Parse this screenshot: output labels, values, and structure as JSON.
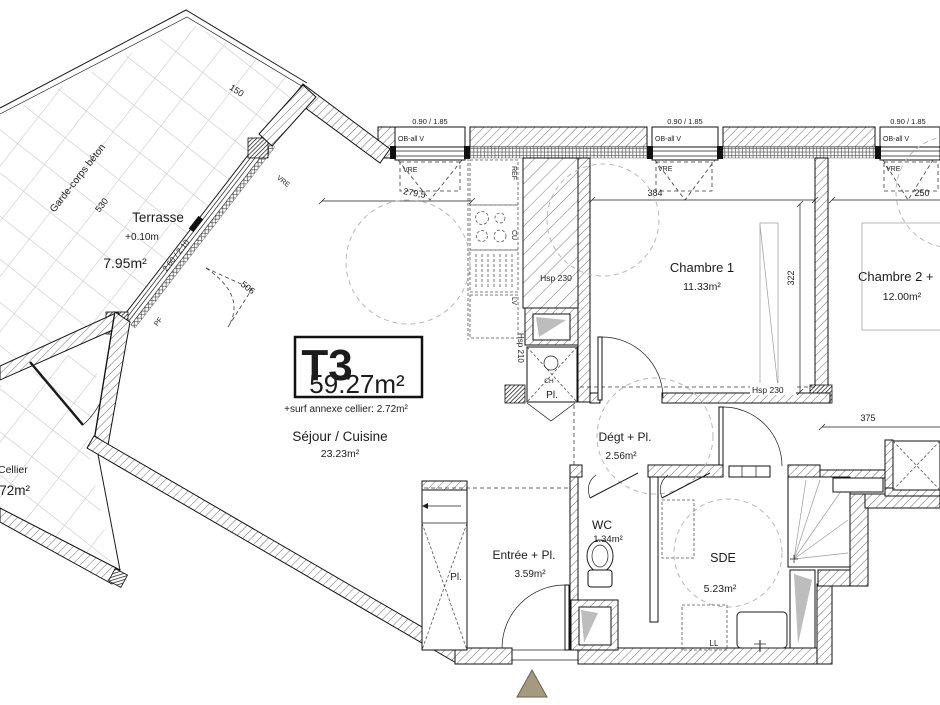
{
  "unit": {
    "type": "T3",
    "area": "59.27m²",
    "annex": "+surf annexe cellier: 2.72m²"
  },
  "rooms": {
    "terrasse": {
      "name": "Terrasse",
      "level": "+0.10m",
      "area": "7.95m²"
    },
    "sejour": {
      "name": "Séjour / Cuisine",
      "area": "23.23m²"
    },
    "chambre1": {
      "name": "Chambre 1",
      "area": "11.33m²"
    },
    "chambre2": {
      "name": "Chambre 2 +",
      "area": "12.00m²"
    },
    "degagement": {
      "name": "Dégt + Pl.",
      "area": "2.56m²"
    },
    "wc": {
      "name": "WC",
      "area": "1.34m²"
    },
    "sde": {
      "name": "SDE",
      "area": "5.23m²"
    },
    "entree": {
      "name": "Entrée + Pl.",
      "area": "3.59m²"
    },
    "cellier": {
      "name": "Cellier",
      "area": "2.72m²"
    }
  },
  "labels": {
    "garde_corps": "Garde-corps béton",
    "pl": "Pl.",
    "ch": "CH",
    "ref": "REF",
    "cu": "CU",
    "lv": "LV",
    "ll": "LL",
    "pf": "PF",
    "vre": "VRE",
    "ob": "OB-all V",
    "hsp230": "Hsp 230",
    "hsp210": "Hsp 210",
    "win_small": "0.90 / 1.85",
    "win_large": "2.60 / 2.10"
  },
  "dimensions": {
    "d150": "150",
    "d530": "530",
    "d506": "506",
    "d279": "279,5",
    "d384": "384",
    "d250": "250",
    "d322": "322",
    "d375": "375"
  },
  "colors": {
    "line": "#1c1c1c",
    "wall_hatch": "#666666",
    "tile_grid": "#cacaca",
    "dashed_guide": "#b8b8b8",
    "entrance_marker": "#a59a7d",
    "fixture_wedge": "#bdbdbd"
  }
}
